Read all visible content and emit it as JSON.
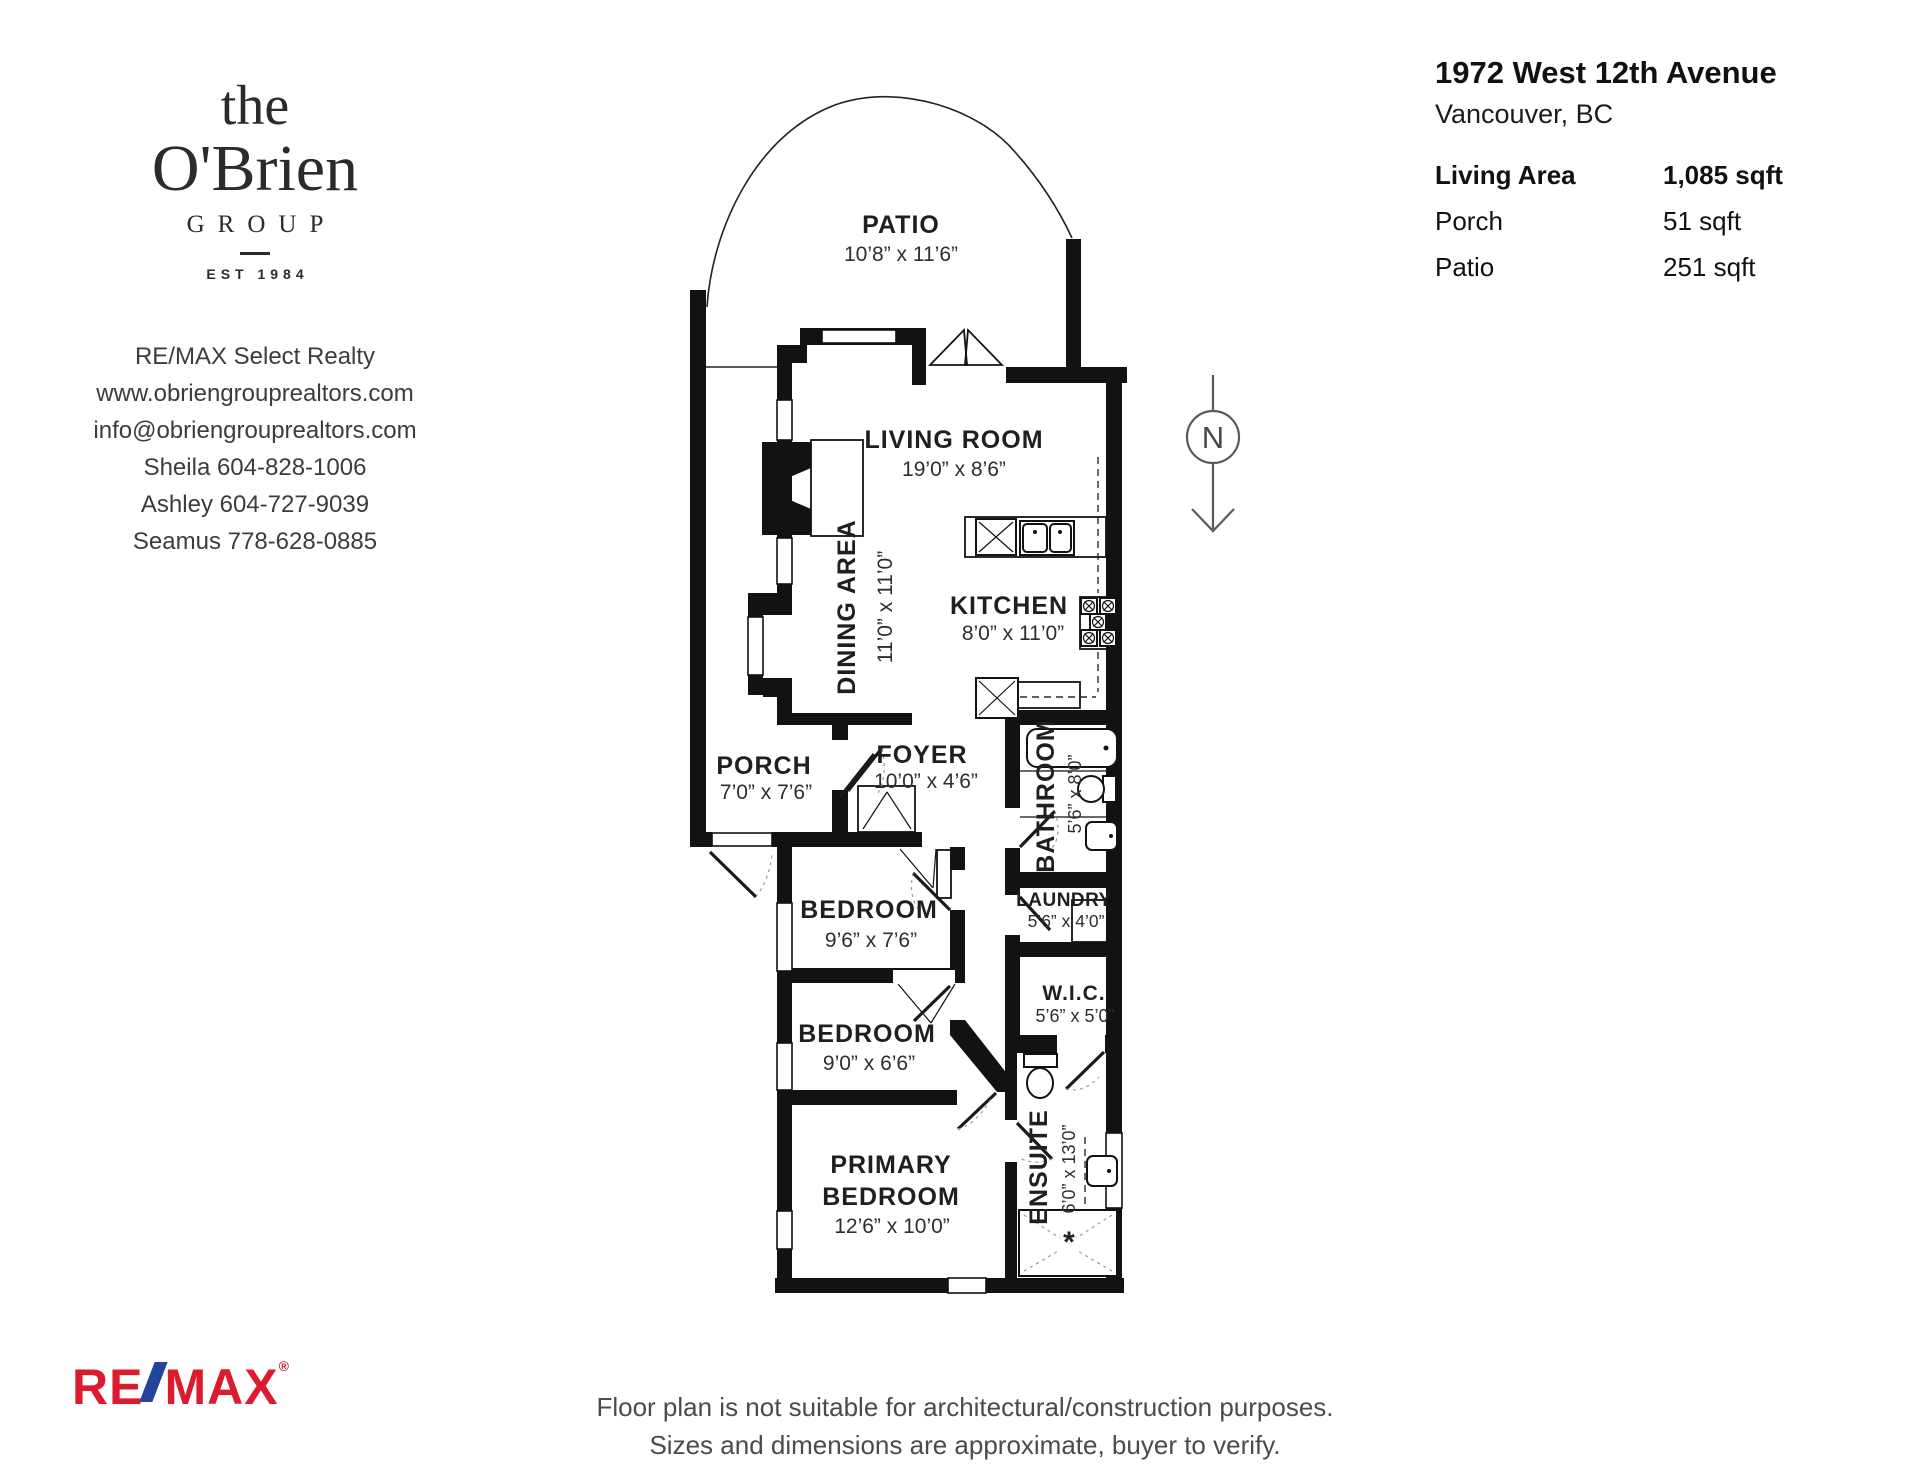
{
  "branding": {
    "logo": {
      "the": "the",
      "name": "O'Brien",
      "group": "GROUP",
      "est": "EST 1984"
    },
    "contact": {
      "company": "RE/MAX Select Realty",
      "website": "www.obriengrouprealtors.com",
      "email": "info@obriengrouprealtors.com",
      "agents": [
        "Sheila 604-828-1006",
        "Ashley 604-727-9039",
        "Seamus 778-628-0885"
      ]
    },
    "remax": {
      "re": "RE",
      "max": "MAX",
      "reg": "®"
    },
    "colors": {
      "remax_red": "#dc1c2e",
      "remax_blue": "#24449c"
    }
  },
  "header": {
    "address": "1972 West 12th Avenue",
    "city": "Vancouver, BC",
    "areas": [
      {
        "label": "Living Area",
        "value": "1,085 sqft"
      },
      {
        "label": "Porch",
        "value": "51 sqft"
      },
      {
        "label": "Patio",
        "value": "251 sqft"
      }
    ]
  },
  "floorplan": {
    "north_label": "N",
    "rooms": {
      "patio": {
        "name": "PATIO",
        "dims": "10’8” x 11’6”"
      },
      "living": {
        "name": "LIVING ROOM",
        "dims": "19’0” x 8’6”"
      },
      "dining": {
        "name": "DINING AREA",
        "dims": "11’0” x 11’0”"
      },
      "kitchen": {
        "name": "KITCHEN",
        "dims": "8’0” x 11’0”"
      },
      "porch": {
        "name": "PORCH",
        "dims": "7’0” x 7’6”"
      },
      "foyer": {
        "name": "FOYER",
        "dims": "10’0” x 4’6”"
      },
      "bathroom": {
        "name": "BATHROOM",
        "dims": "5’6” x 8’0”"
      },
      "laundry": {
        "name": "LAUNDRY",
        "dims": "5’6” x 4’0”"
      },
      "wic": {
        "name": "W.I.C.",
        "dims": "5’6” x 5’0”"
      },
      "bedroom1": {
        "name": "BEDROOM",
        "dims": "9’6” x 7’6”"
      },
      "bedroom2": {
        "name": "BEDROOM",
        "dims": "9’0” x 6’6”"
      },
      "primary": {
        "name_line1": "PRIMARY",
        "name_line2": "BEDROOM",
        "dims": "12’6” x 10’0”"
      },
      "ensuite": {
        "name": "ENSUITE",
        "dims": "6’0” x 13’0”"
      }
    }
  },
  "disclaimer": {
    "line1": "Floor plan is not suitable for architectural/construction purposes.",
    "line2": "Sizes and dimensions are approximate, buyer to verify."
  }
}
